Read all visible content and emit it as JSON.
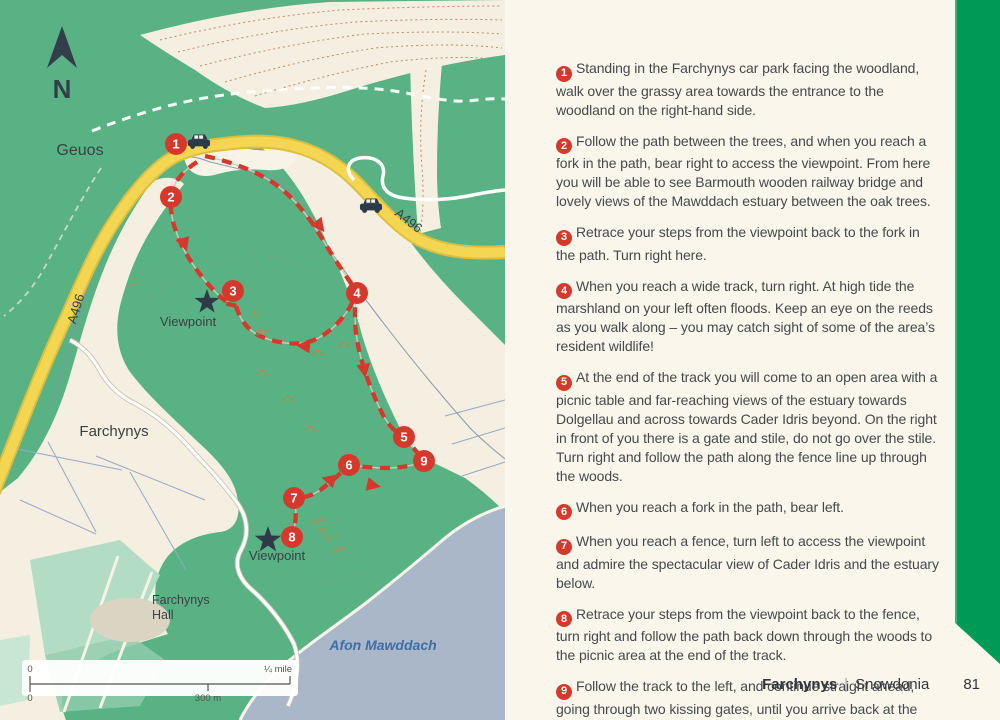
{
  "page": {
    "background_color": "#faf6ec",
    "accent_band_color": "#009a57"
  },
  "footer": {
    "walk_name": "Farchynys",
    "separator": "|",
    "region": "Snowdonia",
    "page_number": "81"
  },
  "map": {
    "labels": {
      "north_letter": "N",
      "geuos": "Geuos",
      "farchynys": "Farchynys",
      "hall_line1": "Farchynys",
      "hall_line2": "Hall",
      "afon_mawddach": "Afon Mawddach",
      "a496_west": "A496",
      "a496_north": "A496",
      "viewpoint_upper": "Viewpoint",
      "viewpoint_lower": "Viewpoint"
    },
    "contours": {
      "c40": "40m",
      "c30": "30m",
      "c20": "20m",
      "c10": "10m"
    },
    "scale_bar": {
      "zero_top": "0",
      "zero_bottom": "0",
      "imperial": "¼ mile",
      "metric": "300 m"
    },
    "markers": [
      "1",
      "2",
      "3",
      "4",
      "5",
      "6",
      "7",
      "8",
      "9"
    ],
    "colors": {
      "land_green": "#59b284",
      "open_land_cream": "#f4efe1",
      "road_yellow": "#f5d653",
      "route_red": "#d6392c",
      "water_blue": "#a9b7c8",
      "dark_symbol": "#2e3a48"
    }
  },
  "directions": {
    "steps": [
      {
        "number": "1",
        "text": "Standing in the Farchynys car park facing the woodland, walk over the grassy area towards the entrance to the woodland on the right-hand side."
      },
      {
        "number": "2",
        "text": "Follow the path between the trees, and when you reach a fork in the path, bear right to access the viewpoint. From here you will be able to see Barmouth wooden railway bridge and lovely views of the Mawddach estuary between the oak trees."
      },
      {
        "number": "3",
        "text": "Retrace your steps from the viewpoint back to the fork in the path. Turn right here."
      },
      {
        "number": "4",
        "text": "When you reach a wide track, turn right. At high tide the marshland on your left often floods. Keep an eye on the reeds as you walk along – you may catch sight of some of the area’s resident wildlife!"
      },
      {
        "number": "5",
        "text": "At the end of the track you will come to an open area with a picnic table and far-reaching views of the estuary towards Dolgellau and across towards Cader Idris beyond. On the right in front of you there is a gate and stile, do not go over the stile. Turn right and follow the path along the fence line up through the woods."
      },
      {
        "number": "6",
        "text": "When you reach a fork in the path, bear left."
      },
      {
        "number": "7",
        "text": "When you reach a fence, turn left to access the viewpoint and admire the spectacular view of Cader Idris and the estuary below."
      },
      {
        "number": "8",
        "text": "Retrace your steps from the viewpoint back to the fence, turn right and follow the path back down through the woods to the picnic area at the end of the track."
      },
      {
        "number": "9",
        "text": "Follow the track to the left, and continue straight ahead, going through two kissing gates, until you arrive back at the car park."
      }
    ]
  }
}
